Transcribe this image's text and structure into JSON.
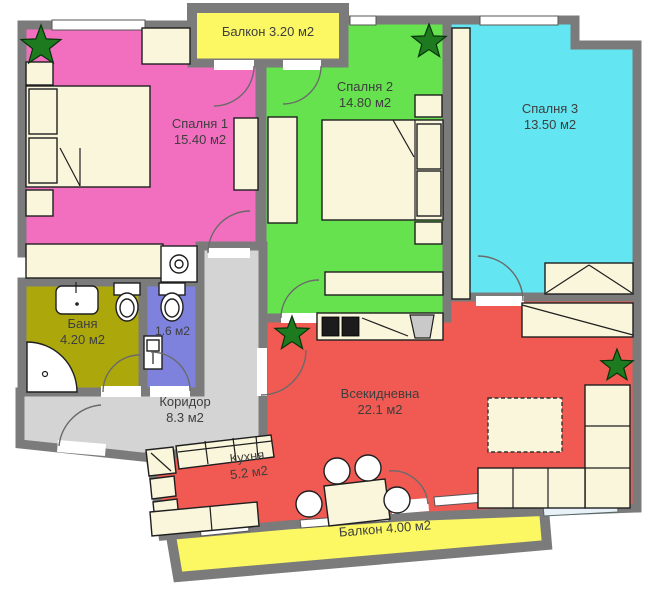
{
  "colors": {
    "wall": "#7B7B7B",
    "bedroom1": "#F26FC0",
    "bedroom2": "#67E24F",
    "bedroom3": "#63E6F2",
    "living": "#F15A52",
    "bathroom": "#ACA80C",
    "wc": "#7E82DC",
    "corridor": "#D4D4D4",
    "balcony": "#FBF863",
    "furniture": "#FAF6DC",
    "plant": "#1E7A1E"
  },
  "rooms": {
    "balcony_top": {
      "label": "Балкон 3.20 м2"
    },
    "bedroom1": {
      "name": "Спалня 1",
      "area": "15.40 м2"
    },
    "bedroom2": {
      "name": "Спалня 2",
      "area": "14.80 м2"
    },
    "bedroom3": {
      "name": "Спалня 3",
      "area": "13.50 м2"
    },
    "bathroom": {
      "name": "Баня",
      "area": "4.20 м2"
    },
    "wc": {
      "area": "1.6 м2"
    },
    "corridor": {
      "name": "Коридор",
      "area": "8.3 м2"
    },
    "living": {
      "name": "Всекидневна",
      "area": "22.1 м2"
    },
    "kitchen": {
      "name": "Кухня",
      "area": "5.2 м2"
    },
    "balcony_bottom": {
      "label": "Балкон 4.00 м2"
    }
  }
}
